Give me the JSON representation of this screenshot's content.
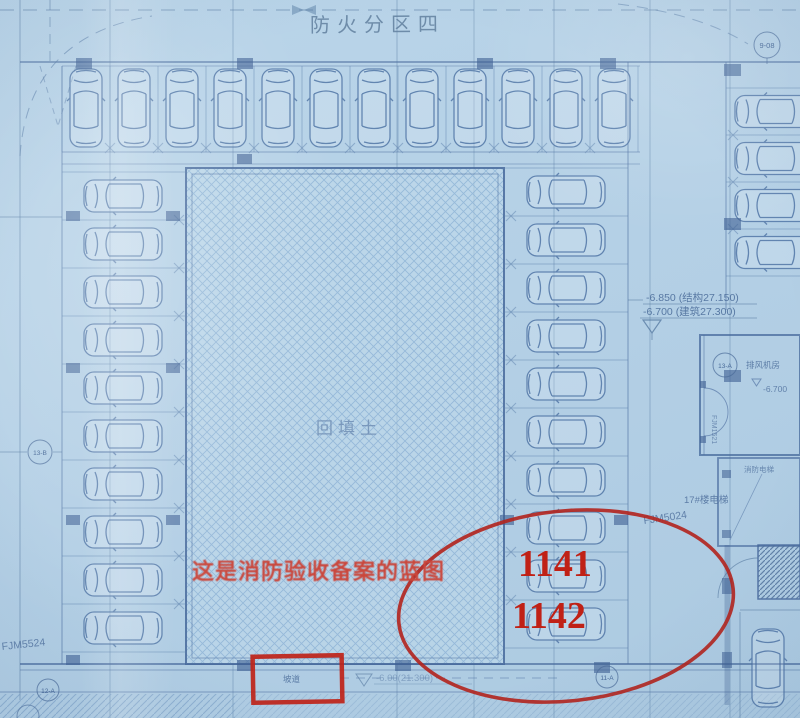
{
  "colors": {
    "annotation_red": "#c02116",
    "ellipse_red": "#b2231d",
    "blueprint_line": "#53779f",
    "paper_blue": "#b5d1e6"
  },
  "title": {
    "zone": "防火分区四"
  },
  "plan": {
    "backfill": "回填土",
    "elevations": {
      "line1": "-6.850 (结构27.150)",
      "line2": "-6.700 (建筑27.300)"
    },
    "rooms": {
      "fan_room": "排风机房",
      "fan_room_elev": "-6.700",
      "elevator": "消防电梯",
      "building": "17#楼电梯"
    },
    "doors": {
      "d1": "FJM5024",
      "d2": "FJM5524",
      "d3": "FJM1521"
    },
    "ramp": {
      "label": "坡道",
      "elev": "-6.00(21.300)"
    },
    "grid_bubbles": {
      "tr": "9-08",
      "right": "13-A",
      "left": "13-B",
      "bl": "12-A",
      "bm": "11-A"
    }
  },
  "annotations": {
    "note": "这是消防验收备案的蓝图",
    "num1": "1141",
    "num2": "1142"
  }
}
